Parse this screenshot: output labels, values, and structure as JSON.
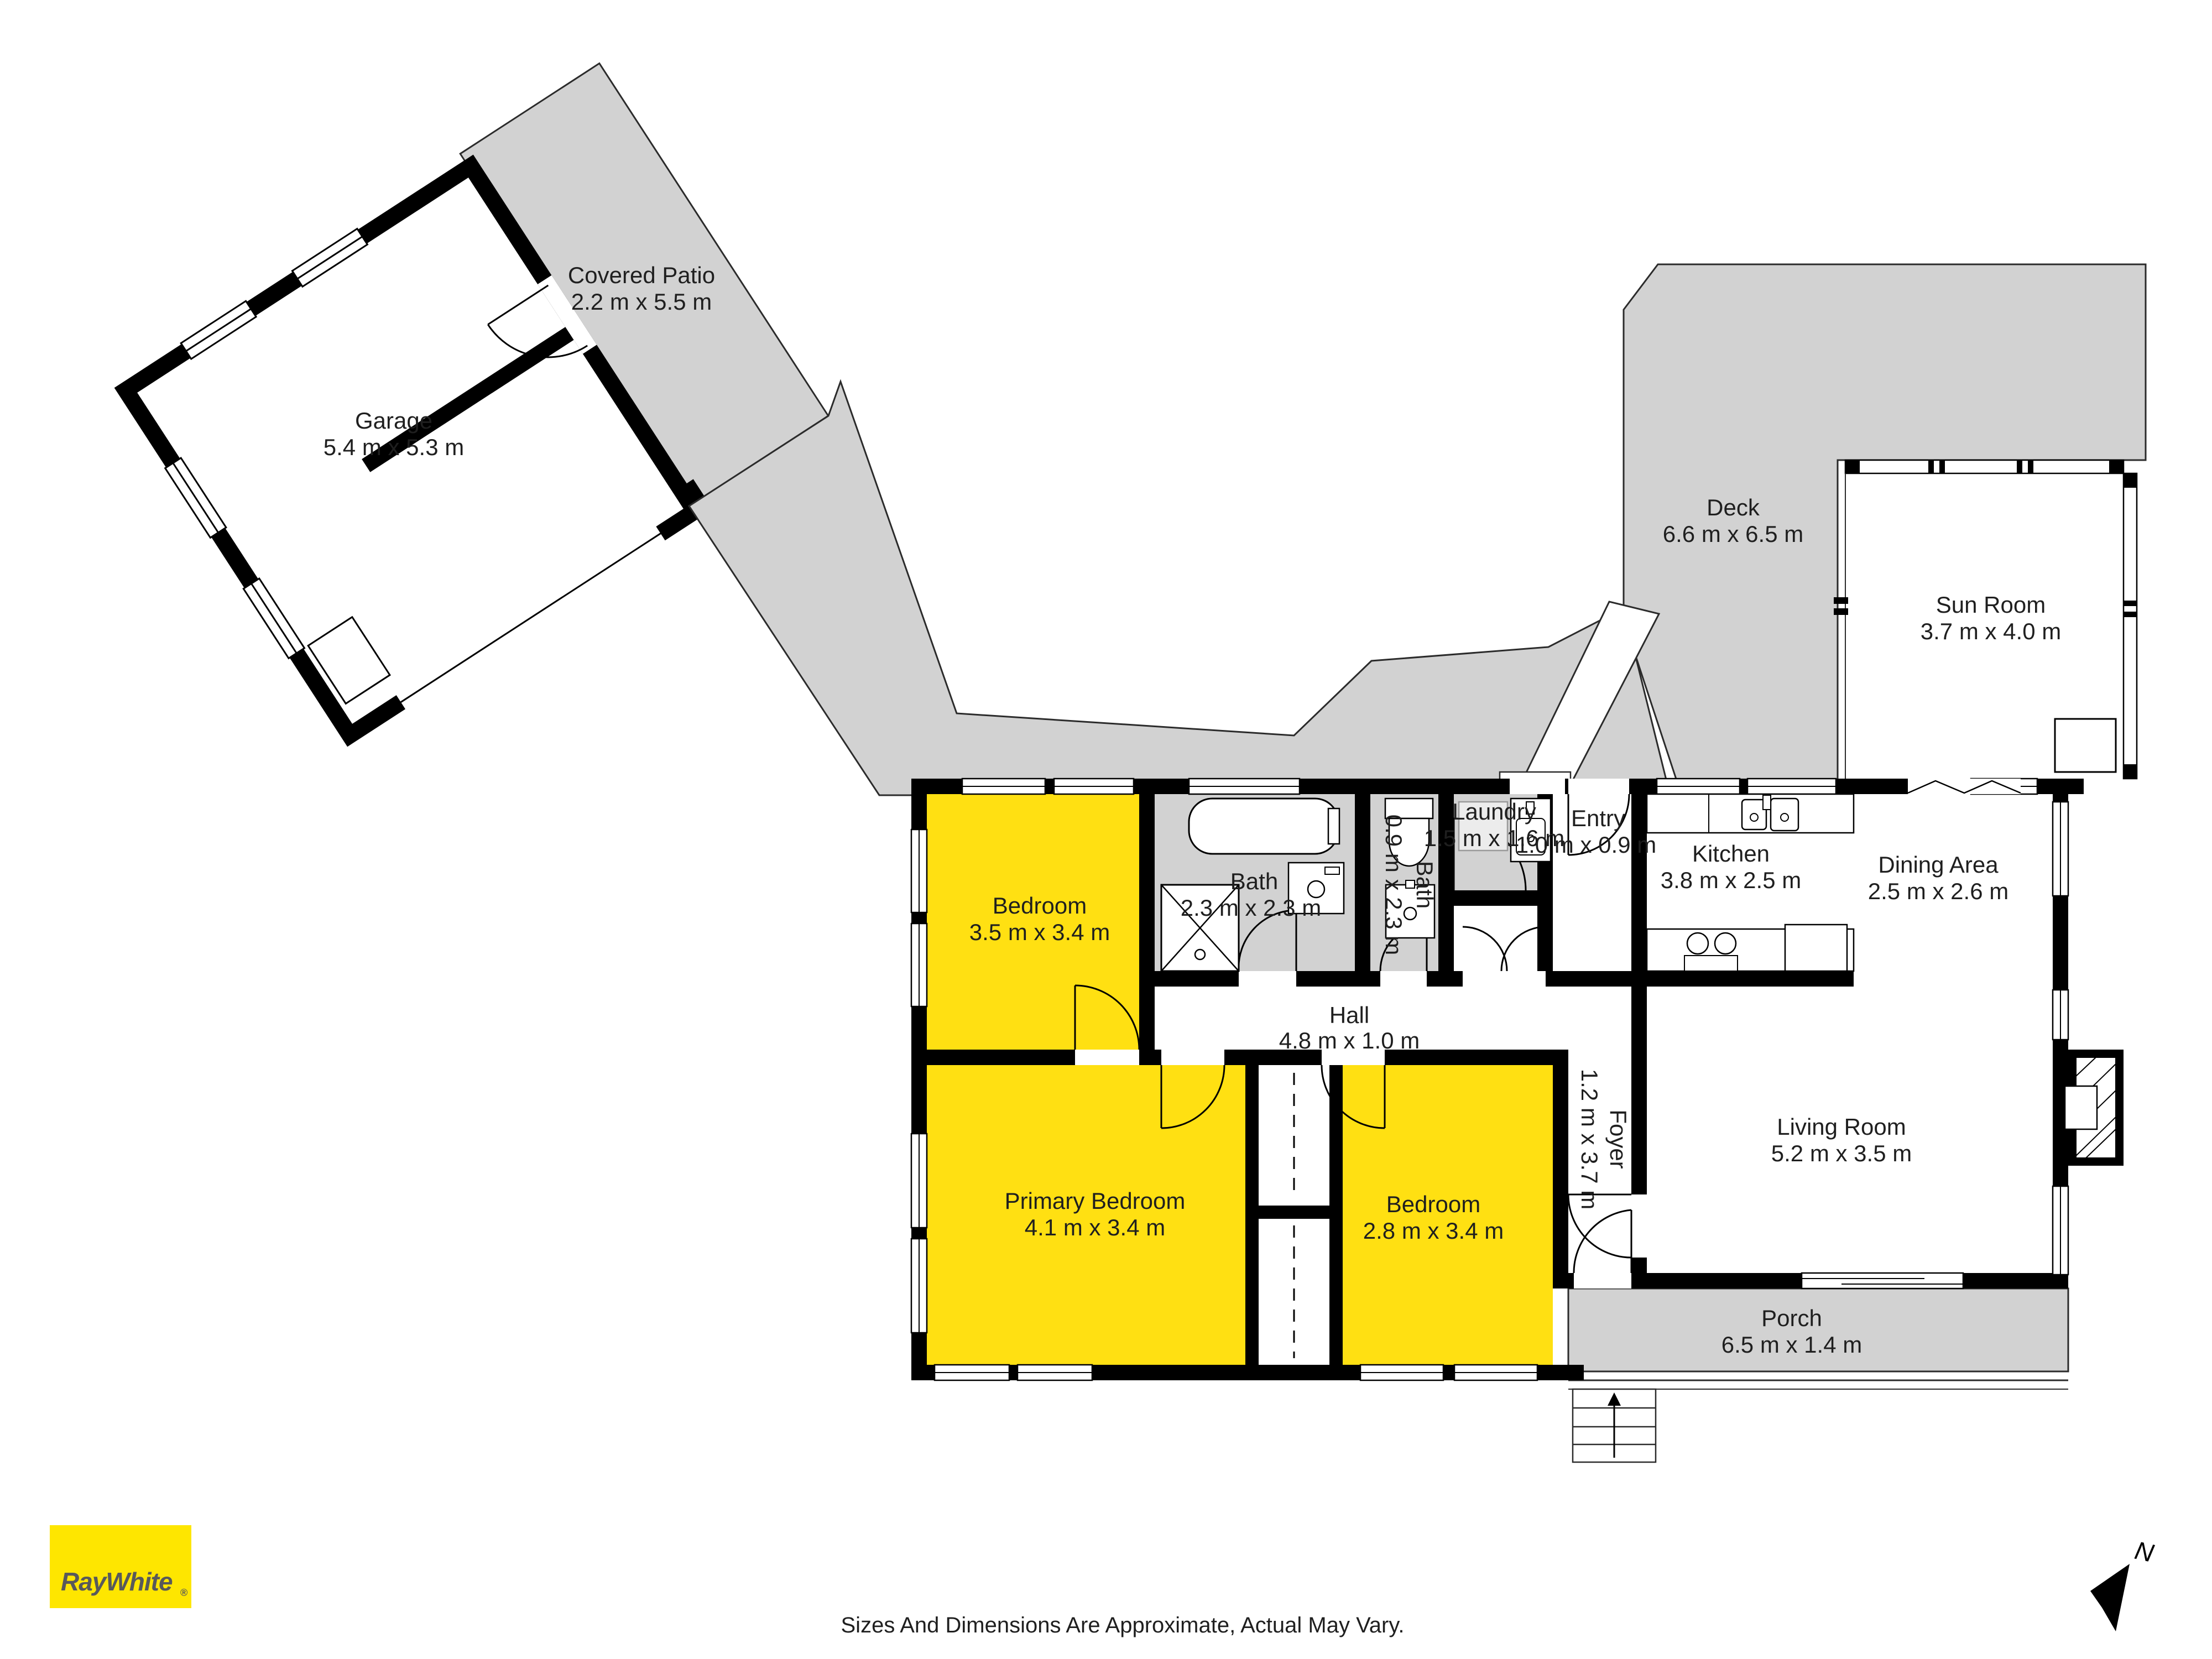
{
  "plan": {
    "rooms": {
      "covered_patio": {
        "name": "Covered Patio",
        "dims": "2.2 m x 5.5 m"
      },
      "garage": {
        "name": "Garage",
        "dims": "5.4 m x 5.3 m"
      },
      "deck": {
        "name": "Deck",
        "dims": "6.6 m x 6.5 m"
      },
      "sun_room": {
        "name": "Sun Room",
        "dims": "3.7 m x 4.0 m"
      },
      "laundry": {
        "name": "Laundry",
        "dims": "1.5 m x 1.6 m"
      },
      "entry": {
        "name": "Entry",
        "dims": "1.0 m x 0.9 m"
      },
      "kitchen": {
        "name": "Kitchen",
        "dims": "3.8 m x 2.5 m"
      },
      "dining": {
        "name": "Dining Area",
        "dims": "2.5 m x 2.6 m"
      },
      "bath": {
        "name": "Bath",
        "dims": "2.3 m x 2.3 m"
      },
      "bath_small": {
        "name": "Bath",
        "dims": "0.9 m x 2.3 m"
      },
      "bedroom_top": {
        "name": "Bedroom",
        "dims": "3.5 m x 3.4 m"
      },
      "hall": {
        "name": "Hall",
        "dims": "4.8 m x 1.0 m"
      },
      "foyer": {
        "name": "Foyer",
        "dims": "1.2 m x 3.7 m"
      },
      "living": {
        "name": "Living Room",
        "dims": "5.2 m x 3.5 m"
      },
      "primary": {
        "name": "Primary Bedroom",
        "dims": "4.1 m x 3.4 m"
      },
      "bedroom_small": {
        "name": "Bedroom",
        "dims": "2.8 m x 3.4 m"
      },
      "porch": {
        "name": "Porch",
        "dims": "6.5 m x 1.4 m"
      }
    },
    "compass": {
      "label": "N"
    },
    "footer": {
      "disclaimer": "Sizes And Dimensions Are Approximate, Actual May Vary."
    },
    "logo": {
      "brand": "RayWhite",
      "registered": "®"
    },
    "colors": {
      "room_yellow": "#FFE012",
      "area_gray": "#D2D2D2",
      "wall_black": "#000000",
      "logo_yellow": "#FEE600",
      "logo_text": "#58595B"
    }
  }
}
